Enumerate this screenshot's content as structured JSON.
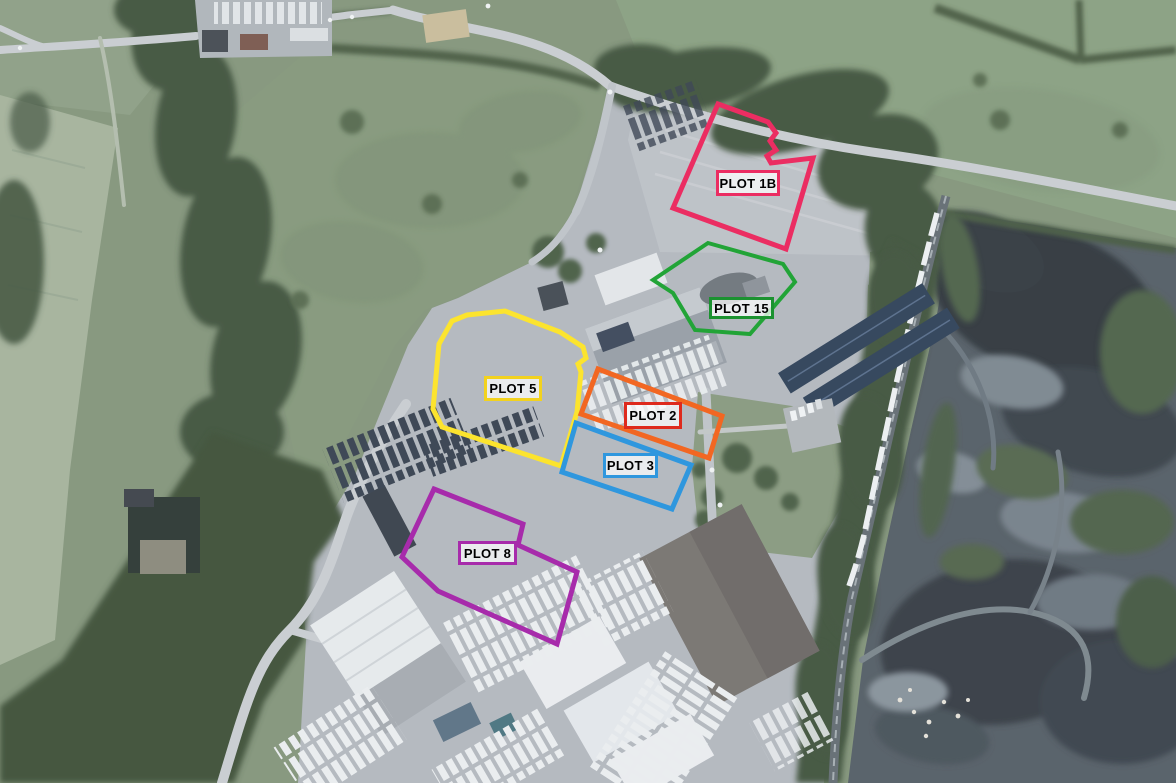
{
  "map": {
    "type": "aerial-site-plan",
    "label_background": "rgba(255,255,255,0.72)",
    "plots": [
      {
        "id": "1B",
        "label": "PLOT 1B",
        "outline_color": "#EB2D62",
        "label_border_color": "#EB2D62",
        "stroke_width": 5,
        "outline_points": [
          [
            718,
            104
          ],
          [
            768,
            122
          ],
          [
            776,
            133
          ],
          [
            770,
            141
          ],
          [
            776,
            150
          ],
          [
            767,
            156
          ],
          [
            771,
            163
          ],
          [
            813,
            158
          ],
          [
            786,
            249
          ],
          [
            673,
            208
          ]
        ],
        "label_box": {
          "x": 716,
          "y": 170,
          "w": 64,
          "h": 26
        }
      },
      {
        "id": "15",
        "label": "PLOT 15",
        "outline_color": "#22A437",
        "label_border_color": "#1B9230",
        "stroke_width": 4,
        "outline_points": [
          [
            708,
            243
          ],
          [
            783,
            264
          ],
          [
            795,
            282
          ],
          [
            750,
            334
          ],
          [
            695,
            330
          ],
          [
            673,
            293
          ],
          [
            653,
            280
          ]
        ],
        "label_box": {
          "x": 709,
          "y": 297,
          "w": 65,
          "h": 22
        }
      },
      {
        "id": "5",
        "label": "PLOT 5",
        "outline_color": "#FCE42E",
        "label_border_color": "#F2D21E",
        "stroke_width": 5,
        "outline_points": [
          [
            452,
            321
          ],
          [
            467,
            315
          ],
          [
            505,
            311
          ],
          [
            560,
            332
          ],
          [
            583,
            347
          ],
          [
            586,
            358
          ],
          [
            578,
            364
          ],
          [
            581,
            372
          ],
          [
            577,
            412
          ],
          [
            561,
            466
          ],
          [
            442,
            427
          ],
          [
            433,
            409
          ],
          [
            439,
            344
          ]
        ],
        "label_box": {
          "x": 484,
          "y": 376,
          "w": 58,
          "h": 25
        }
      },
      {
        "id": "2",
        "label": "PLOT 2",
        "outline_color": "#F26722",
        "label_border_color": "#DE2A1D",
        "stroke_width": 5,
        "outline_points": [
          [
            598,
            369
          ],
          [
            722,
            416
          ],
          [
            709,
            458
          ],
          [
            581,
            414
          ]
        ],
        "label_box": {
          "x": 624,
          "y": 402,
          "w": 58,
          "h": 27
        }
      },
      {
        "id": "3",
        "label": "PLOT 3",
        "outline_color": "#2F97DE",
        "label_border_color": "#2F97DE",
        "stroke_width": 5,
        "outline_points": [
          [
            576,
            423
          ],
          [
            691,
            465
          ],
          [
            672,
            509
          ],
          [
            562,
            472
          ]
        ],
        "label_box": {
          "x": 603,
          "y": 453,
          "w": 55,
          "h": 25
        }
      },
      {
        "id": "8",
        "label": "PLOT 8",
        "outline_color": "#A72BAB",
        "label_border_color": "#A72BAB",
        "stroke_width": 5,
        "outline_points": [
          [
            434,
            489
          ],
          [
            523,
            524
          ],
          [
            518,
            545
          ],
          [
            577,
            572
          ],
          [
            557,
            644
          ],
          [
            438,
            591
          ],
          [
            402,
            557
          ]
        ],
        "label_box": {
          "x": 458,
          "y": 541,
          "w": 59,
          "h": 24
        }
      }
    ]
  }
}
